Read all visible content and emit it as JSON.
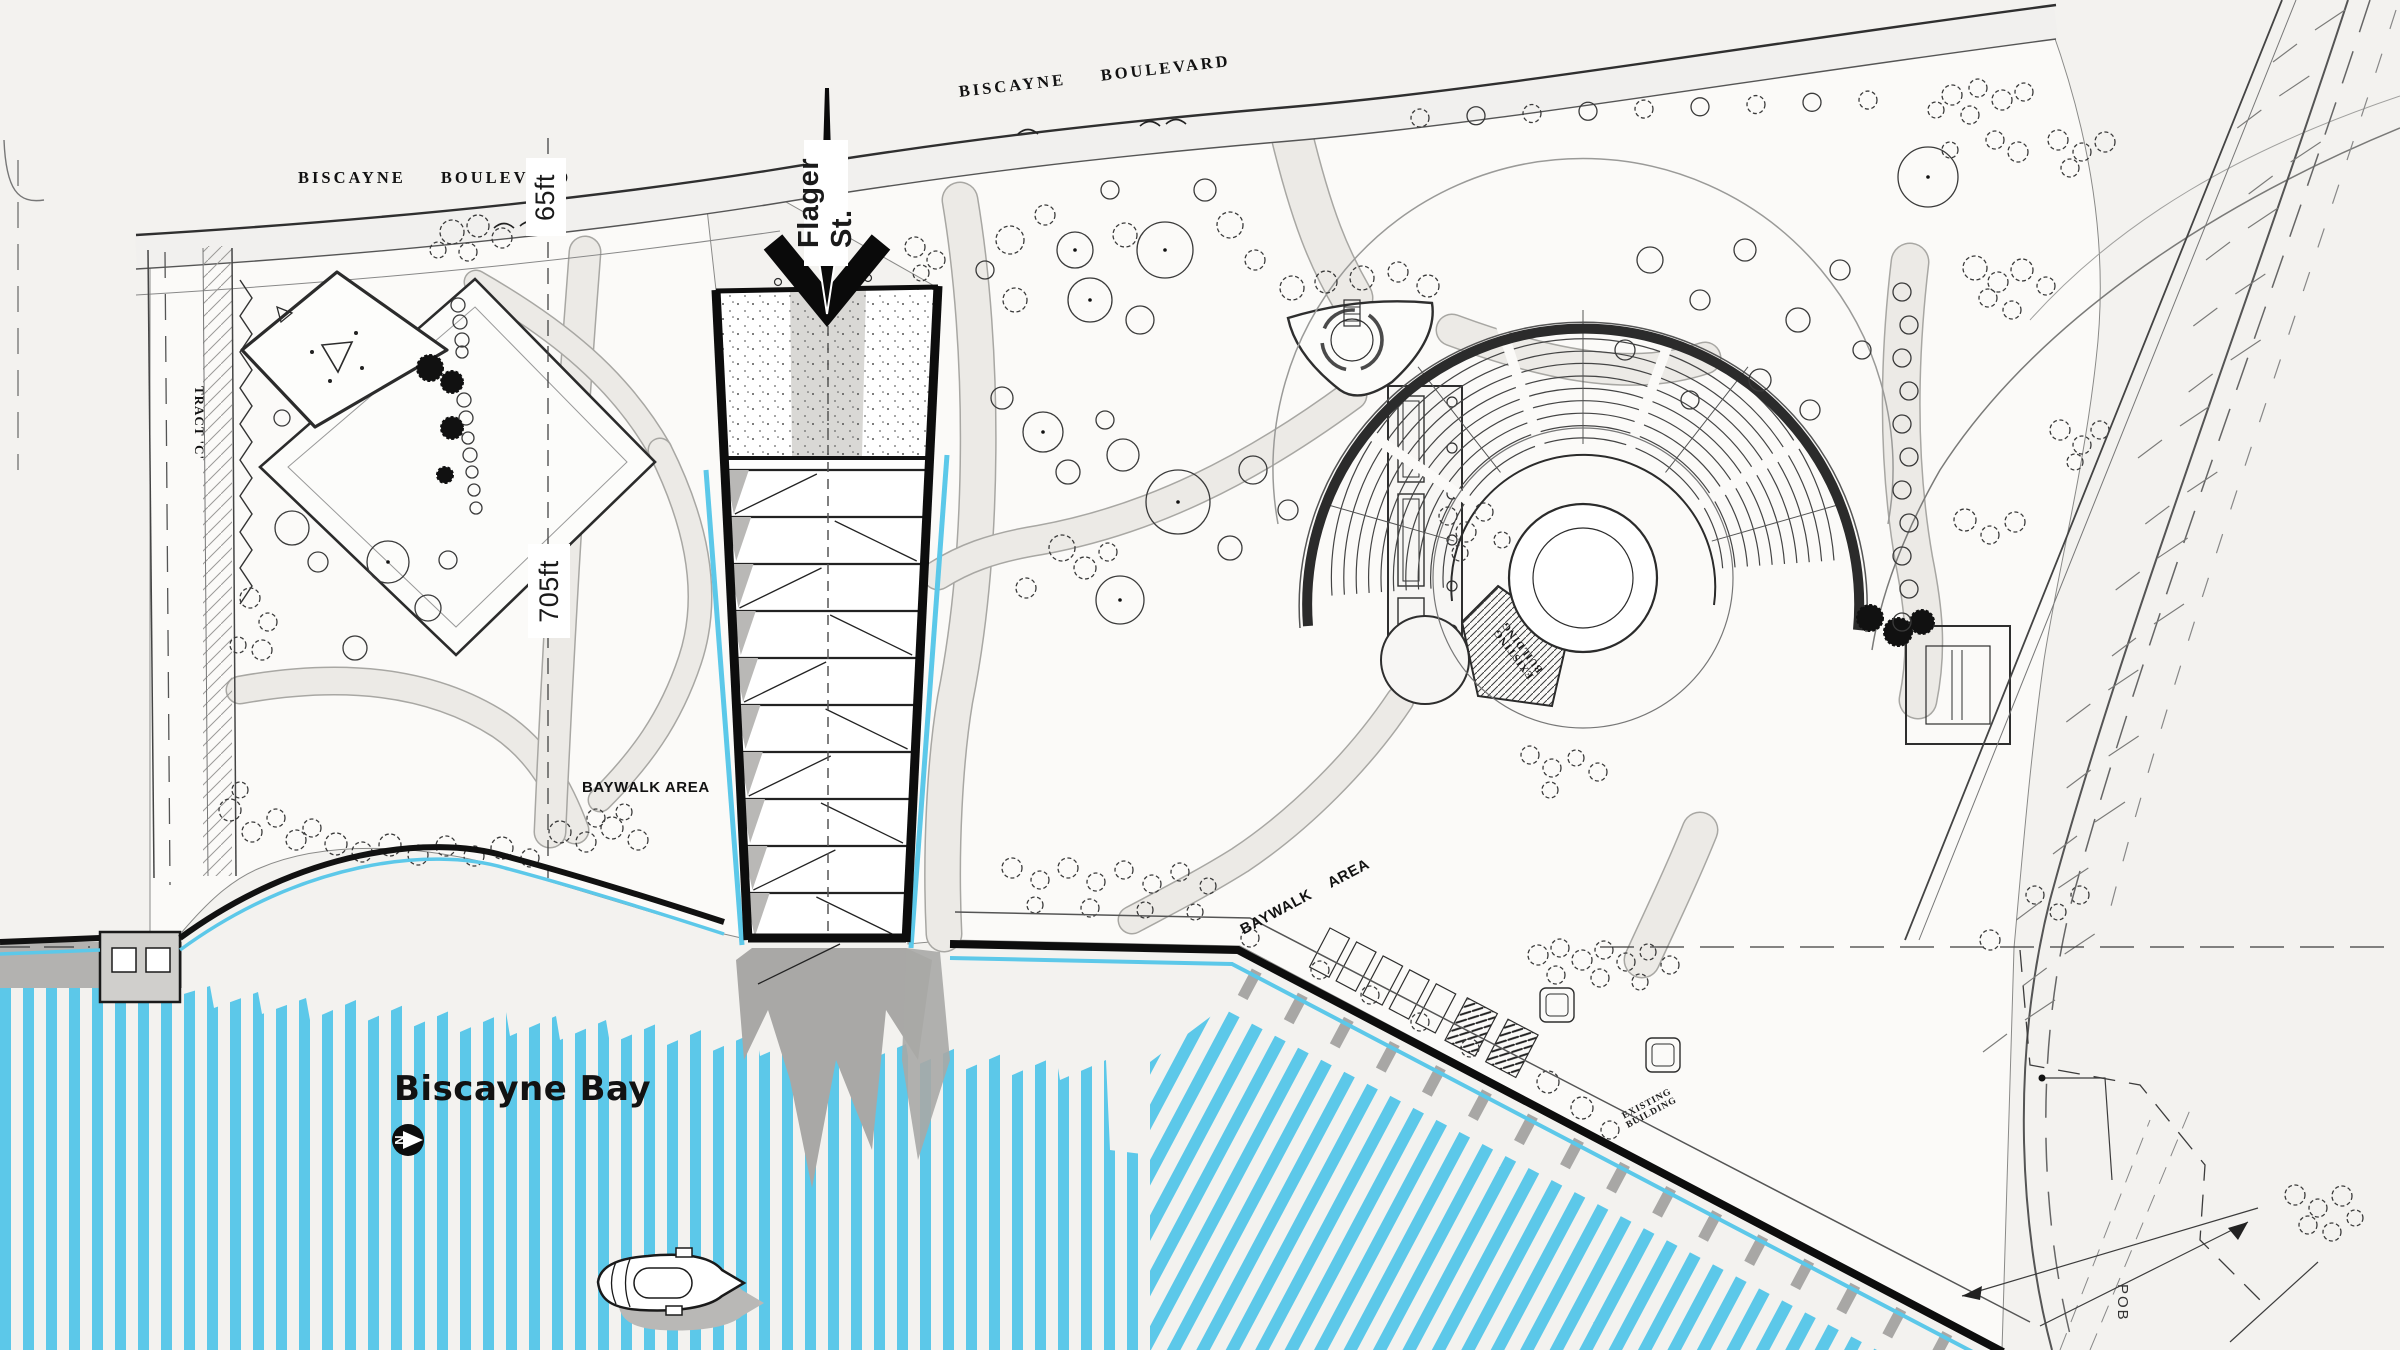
{
  "colors": {
    "paper": "#f3f2ef",
    "park": "#fbfaf8",
    "ink": "#1c1c1c",
    "water_blue": "#5cc8e9",
    "shadow_gray": "#a9a8a6",
    "path_gray": "#eceae6"
  },
  "labels": {
    "boulevard_left": "BISCAYNE BOULEVARD",
    "boulevard_top": "BISCAYNE BOULEVARD",
    "flagler_street": "Flager St.",
    "dim_width": "65ft",
    "dim_length": "705ft",
    "baywalk_left": "BAYWALK AREA",
    "baywalk_right": "BAYWALK AREA",
    "bay_name": "Biscayne Bay",
    "tract_c": "TRACT 'C'",
    "pob": "POB",
    "existing_building_word1": "EXISTING",
    "existing_building_word2": "BUILDING",
    "north_letter": "N"
  }
}
